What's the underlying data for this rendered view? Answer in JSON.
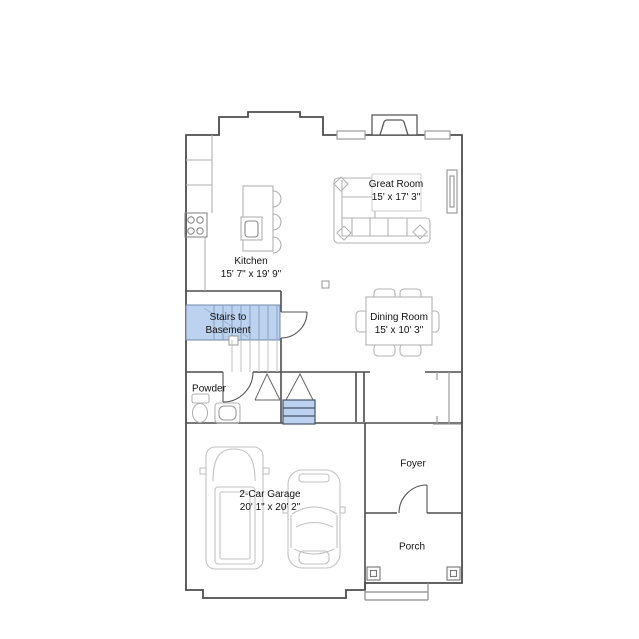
{
  "colors": {
    "background": "#ffffff",
    "wall_line": "#4d4d4d",
    "furniture_line": "#b3b3b3",
    "stairs_highlight_fill": "#bcd2ee",
    "stairs_highlight_line": "#44546a",
    "label_text": "#111111"
  },
  "rooms": {
    "kitchen": {
      "name": "Kitchen",
      "dims": "15' 7\" x 19' 9\""
    },
    "great_room": {
      "name": "Great Room",
      "dims": "15' x 17' 3\""
    },
    "dining_room": {
      "name": "Dining Room",
      "dims": "15' x 10' 3\""
    },
    "stairs": {
      "line1": "Stairs to",
      "line2": "Basement"
    },
    "powder": {
      "name": "Powder"
    },
    "garage": {
      "name": "2-Car Garage",
      "dims": "20' 1\" x 20' 2\""
    },
    "foyer": {
      "name": "Foyer"
    },
    "porch": {
      "name": "Porch"
    }
  }
}
